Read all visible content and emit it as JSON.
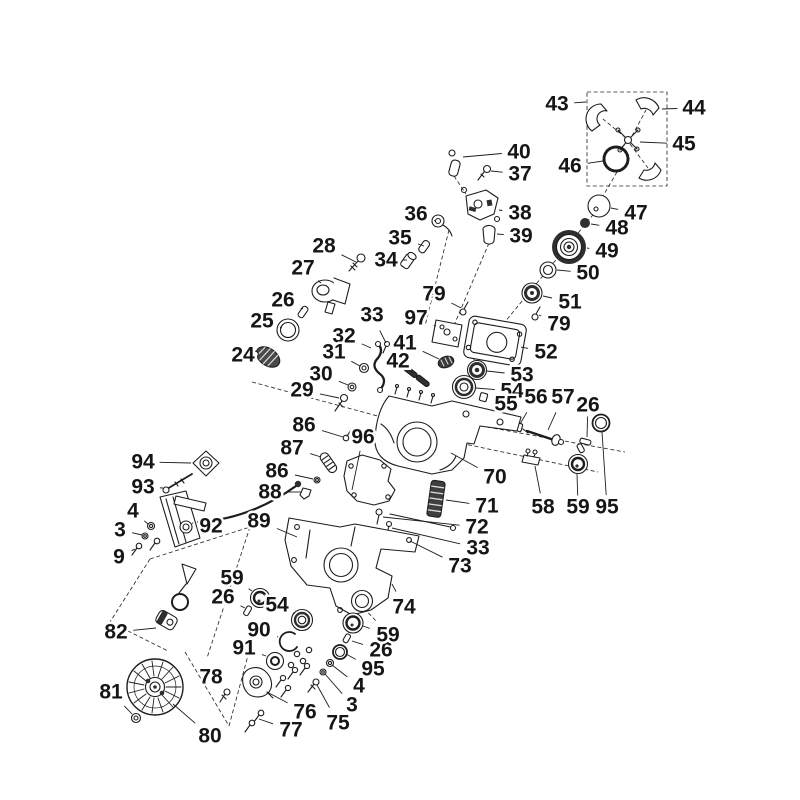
{
  "figure": {
    "type": "exploded-parts-diagram",
    "background": "#ffffff",
    "line_color": "#1d1d1d",
    "label_color": "#161616"
  },
  "callouts": [
    {
      "n": "43",
      "x": 557,
      "y": 104,
      "tx": 586,
      "ty": 102
    },
    {
      "n": "44",
      "x": 694,
      "y": 108,
      "tx": 662,
      "ty": 109
    },
    {
      "n": "45",
      "x": 684,
      "y": 144,
      "tx": 640,
      "ty": 142
    },
    {
      "n": "46",
      "x": 570,
      "y": 166,
      "tx": 603,
      "ty": 161
    },
    {
      "n": "47",
      "x": 636,
      "y": 213,
      "tx": 611,
      "ty": 208
    },
    {
      "n": "48",
      "x": 617,
      "y": 228,
      "tx": 591,
      "ty": 224
    },
    {
      "n": "49",
      "x": 607,
      "y": 251,
      "tx": 587,
      "ty": 248
    },
    {
      "n": "50",
      "x": 588,
      "y": 273,
      "tx": 557,
      "ty": 270
    },
    {
      "n": "51",
      "x": 570,
      "y": 302,
      "tx": 543,
      "ty": 296
    },
    {
      "n": "40",
      "x": 519,
      "y": 152,
      "tx": 463,
      "ty": 157
    },
    {
      "n": "37",
      "x": 520,
      "y": 174,
      "tx": 491,
      "ty": 171
    },
    {
      "n": "38",
      "x": 520,
      "y": 213,
      "tx": 499,
      "ty": 210
    },
    {
      "n": "39",
      "x": 521,
      "y": 236,
      "tx": 497,
      "ty": 234
    },
    {
      "n": "36",
      "x": 416,
      "y": 214,
      "tx": 435,
      "ty": 221
    },
    {
      "n": "35",
      "x": 400,
      "y": 238,
      "tx": 424,
      "ty": 246
    },
    {
      "n": "34",
      "x": 386,
      "y": 260,
      "tx": 407,
      "ty": 260
    },
    {
      "n": "28",
      "x": 324,
      "y": 246,
      "tx": 356,
      "ty": 262
    },
    {
      "n": "27",
      "x": 303,
      "y": 268,
      "tx": 321,
      "ty": 283
    },
    {
      "n": "26",
      "x": 283,
      "y": 300,
      "tx": 303,
      "ty": 309
    },
    {
      "n": "25",
      "x": 262,
      "y": 321,
      "tx": 282,
      "ty": 328
    },
    {
      "n": "24",
      "x": 243,
      "y": 355,
      "tx": 260,
      "ty": 356
    },
    {
      "n": "33",
      "x": 372,
      "y": 315,
      "tx": 386,
      "ty": 343
    },
    {
      "n": "97",
      "x": 416,
      "y": 318,
      "tx": 436,
      "ty": 326
    },
    {
      "n": "32",
      "x": 344,
      "y": 336,
      "tx": 371,
      "ty": 348
    },
    {
      "n": "31",
      "x": 334,
      "y": 352,
      "tx": 360,
      "ty": 366
    },
    {
      "n": "41",
      "x": 405,
      "y": 343,
      "tx": 439,
      "ty": 359
    },
    {
      "n": "42",
      "x": 398,
      "y": 361,
      "tx": 408,
      "ty": 369
    },
    {
      "n": "30",
      "x": 321,
      "y": 374,
      "tx": 348,
      "ty": 385
    },
    {
      "n": "29",
      "x": 302,
      "y": 390,
      "tx": 339,
      "ty": 398
    },
    {
      "n": "79",
      "x": 434,
      "y": 294,
      "tx": 461,
      "ty": 308
    },
    {
      "n": "79",
      "x": 559,
      "y": 324,
      "tx": 539,
      "ty": 315
    },
    {
      "n": "52",
      "x": 546,
      "y": 352,
      "tx": 521,
      "ty": 347
    },
    {
      "n": "53",
      "x": 522,
      "y": 375,
      "tx": 487,
      "ty": 371
    },
    {
      "n": "54",
      "x": 512,
      "y": 391,
      "tx": 476,
      "ty": 388
    },
    {
      "n": "55",
      "x": 506,
      "y": 404,
      "tx": 488,
      "ty": 398
    },
    {
      "n": "56",
      "x": 536,
      "y": 397,
      "tx": 520,
      "ty": 424
    },
    {
      "n": "57",
      "x": 563,
      "y": 397,
      "tx": 548,
      "ty": 430
    },
    {
      "n": "26",
      "x": 588,
      "y": 405,
      "tx": 587,
      "ty": 437
    },
    {
      "n": "95",
      "x": 607,
      "y": 507,
      "tx": 602,
      "ty": 432
    },
    {
      "n": "58",
      "x": 543,
      "y": 507,
      "tx": 535,
      "ty": 466
    },
    {
      "n": "59",
      "x": 578,
      "y": 507,
      "tx": 577,
      "ty": 474
    },
    {
      "n": "70",
      "x": 495,
      "y": 477,
      "tx": 451,
      "ty": 453
    },
    {
      "n": "71",
      "x": 487,
      "y": 506,
      "tx": 446,
      "ty": 500
    },
    {
      "n": "72",
      "x": 477,
      "y": 527,
      "tx": 383,
      "ty": 517
    },
    {
      "n": "33",
      "x": 478,
      "y": 548,
      "tx": 392,
      "ty": 528
    },
    {
      "n": "73",
      "x": 460,
      "y": 566,
      "tx": 410,
      "ty": 541
    },
    {
      "n": "74",
      "x": 404,
      "y": 607,
      "tx": 392,
      "ty": 584
    },
    {
      "n": "96",
      "x": 363,
      "y": 437,
      "tx": 352,
      "ty": 490
    },
    {
      "n": "86",
      "x": 304,
      "y": 425,
      "tx": 343,
      "ty": 437
    },
    {
      "n": "87",
      "x": 292,
      "y": 448,
      "tx": 321,
      "ty": 457
    },
    {
      "n": "86",
      "x": 277,
      "y": 471,
      "tx": 313,
      "ty": 479
    },
    {
      "n": "88",
      "x": 270,
      "y": 492,
      "tx": 301,
      "ty": 492
    },
    {
      "n": "89",
      "x": 259,
      "y": 521,
      "tx": 297,
      "ty": 537
    },
    {
      "n": "94",
      "x": 143,
      "y": 462,
      "tx": 191,
      "ty": 463
    },
    {
      "n": "93",
      "x": 143,
      "y": 487,
      "tx": 163,
      "ty": 488
    },
    {
      "n": "92",
      "x": 211,
      "y": 526,
      "tx": 192,
      "ty": 523
    },
    {
      "n": "4",
      "x": 133,
      "y": 511,
      "tx": 148,
      "ty": 524
    },
    {
      "n": "3",
      "x": 120,
      "y": 530,
      "tx": 142,
      "ty": 535
    },
    {
      "n": "9",
      "x": 119,
      "y": 557,
      "tx": 135,
      "ty": 549
    },
    {
      "n": "82",
      "x": 116,
      "y": 632,
      "tx": 156,
      "ty": 628
    },
    {
      "n": "81",
      "x": 111,
      "y": 692,
      "tx": 132,
      "ty": 714
    },
    {
      "n": "80",
      "x": 210,
      "y": 736,
      "tx": 173,
      "ty": 704
    },
    {
      "n": "78",
      "x": 211,
      "y": 677,
      "tx": 224,
      "ty": 691
    },
    {
      "n": "59",
      "x": 232,
      "y": 578,
      "tx": 252,
      "ty": 591
    },
    {
      "n": "26",
      "x": 223,
      "y": 597,
      "tx": 245,
      "ty": 608
    },
    {
      "n": "54",
      "x": 277,
      "y": 605,
      "tx": 293,
      "ty": 613
    },
    {
      "n": "90",
      "x": 259,
      "y": 630,
      "tx": 278,
      "ty": 637
    },
    {
      "n": "91",
      "x": 244,
      "y": 648,
      "tx": 266,
      "ty": 656
    },
    {
      "n": "76",
      "x": 305,
      "y": 712,
      "tx": 267,
      "ty": 692
    },
    {
      "n": "77",
      "x": 291,
      "y": 730,
      "tx": 259,
      "ty": 719
    },
    {
      "n": "75",
      "x": 338,
      "y": 723,
      "tx": 317,
      "ty": 685
    },
    {
      "n": "3",
      "x": 352,
      "y": 705,
      "tx": 325,
      "ty": 674
    },
    {
      "n": "4",
      "x": 359,
      "y": 686,
      "tx": 332,
      "ty": 665
    },
    {
      "n": "95",
      "x": 373,
      "y": 669,
      "tx": 346,
      "ty": 654
    },
    {
      "n": "26",
      "x": 381,
      "y": 650,
      "tx": 352,
      "ty": 641
    },
    {
      "n": "59",
      "x": 388,
      "y": 635,
      "tx": 363,
      "ty": 626
    }
  ]
}
